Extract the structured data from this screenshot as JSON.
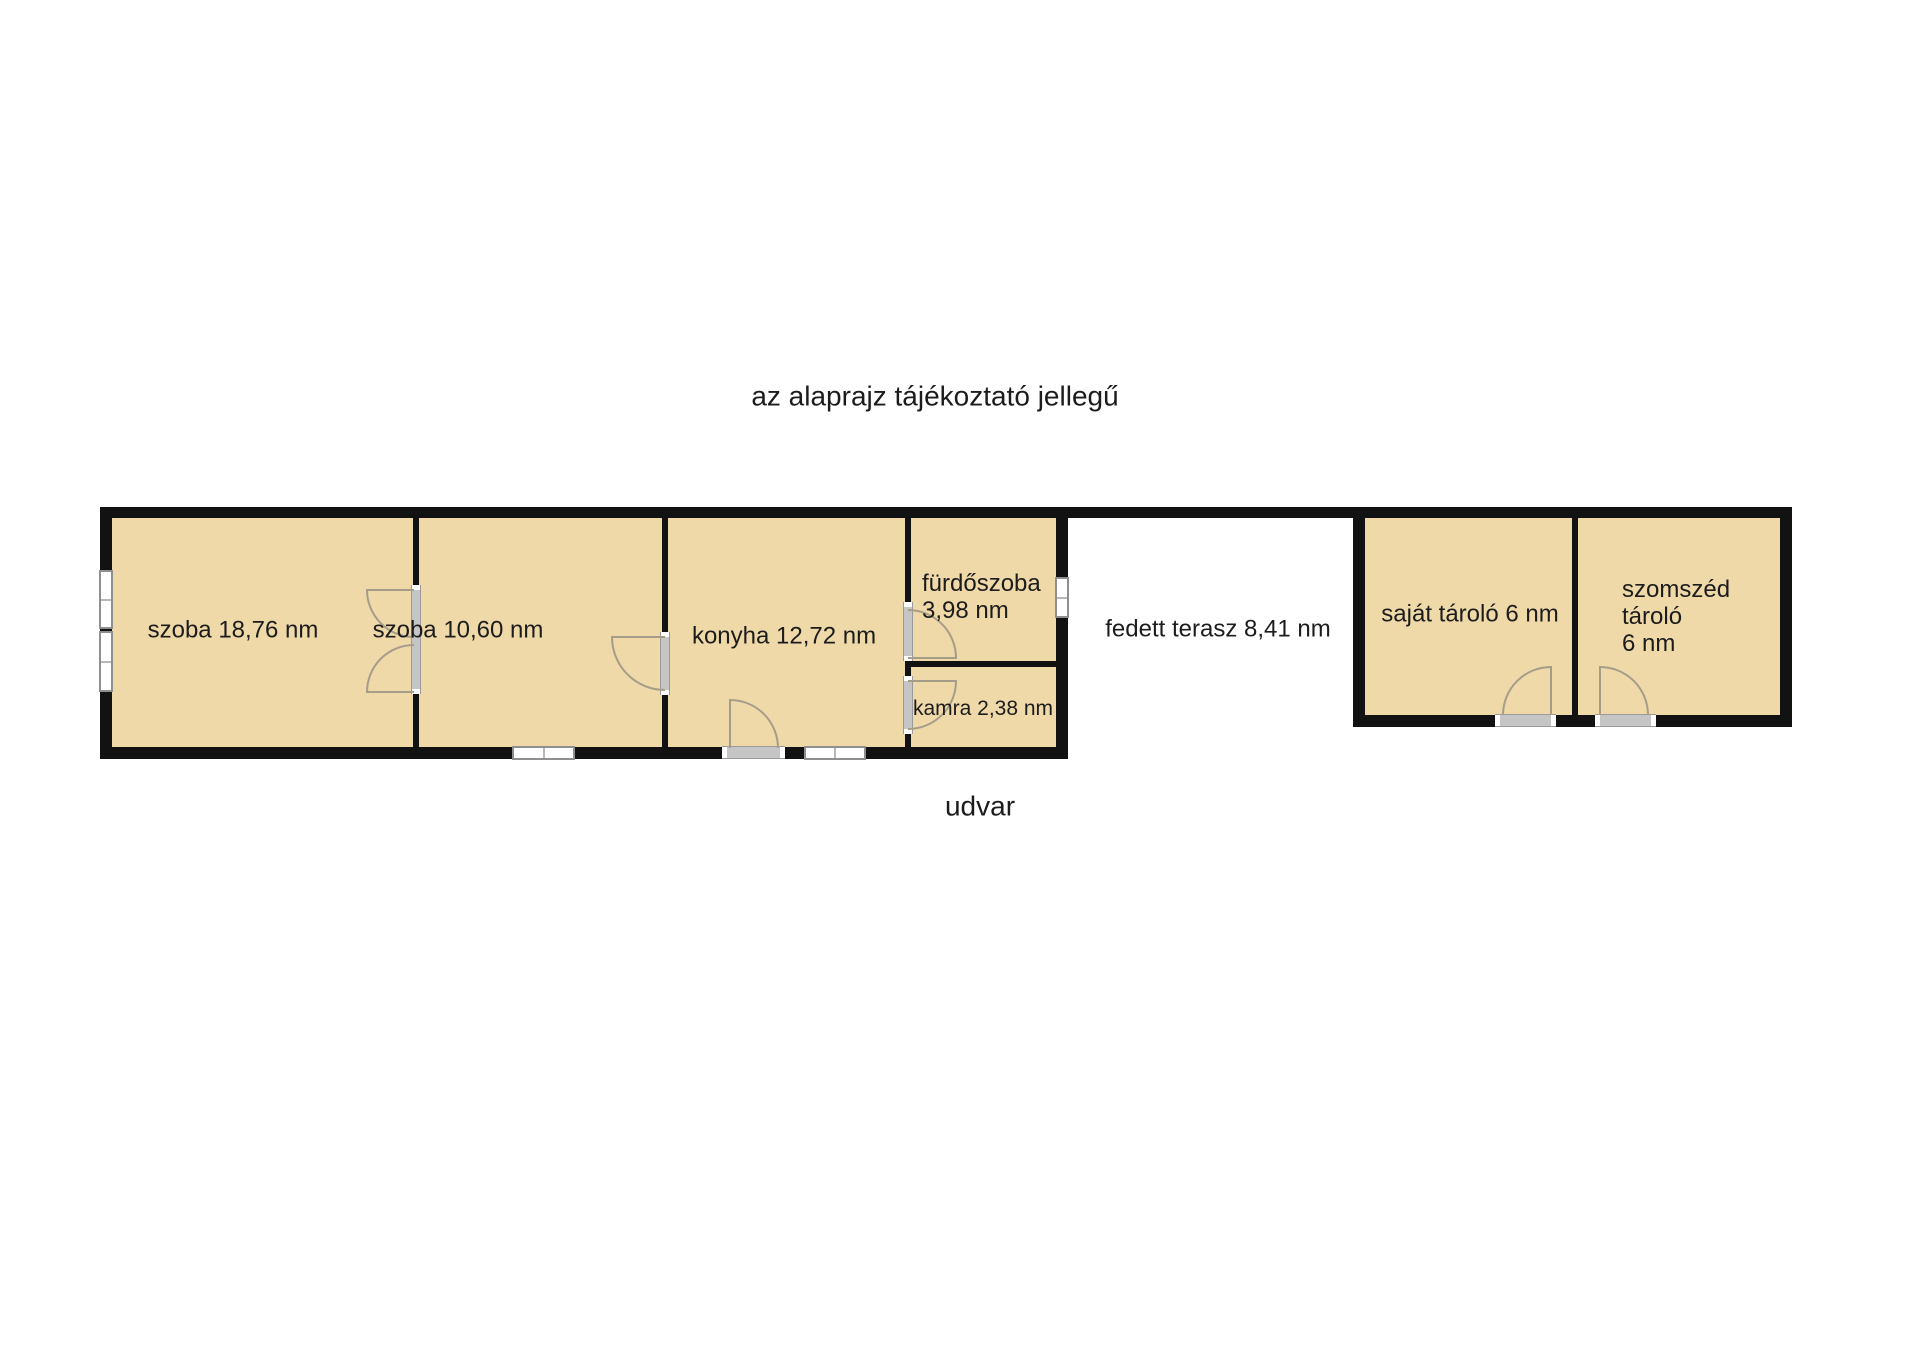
{
  "title": "az alaprajz tájékoztató jellegű",
  "rooms": {
    "szoba1": "szoba 18,76 nm",
    "szoba2": "szoba 10,60 nm",
    "konyha": "konyha 12,72 nm",
    "furdoszoba_line1": "fürdőszoba",
    "furdoszoba_line2": "3,98 nm",
    "kamra": "kamra 2,38 nm",
    "terasz": "fedett terasz 8,41 nm",
    "sajat_tarolo": "saját tároló 6 nm",
    "szomszed_line1": "szomszéd",
    "szomszed_line2": "tároló",
    "szomszed_line3": "6 nm"
  },
  "outside": {
    "udvar": "udvar"
  },
  "colors": {
    "room_fill": "#efd9a8",
    "wall": "#121212",
    "door_leaf": "#c5c5c5",
    "door_arc": "#a69d89",
    "window_frame": "#8f8f8f",
    "background": "#ffffff",
    "text": "#1c1c1c"
  }
}
